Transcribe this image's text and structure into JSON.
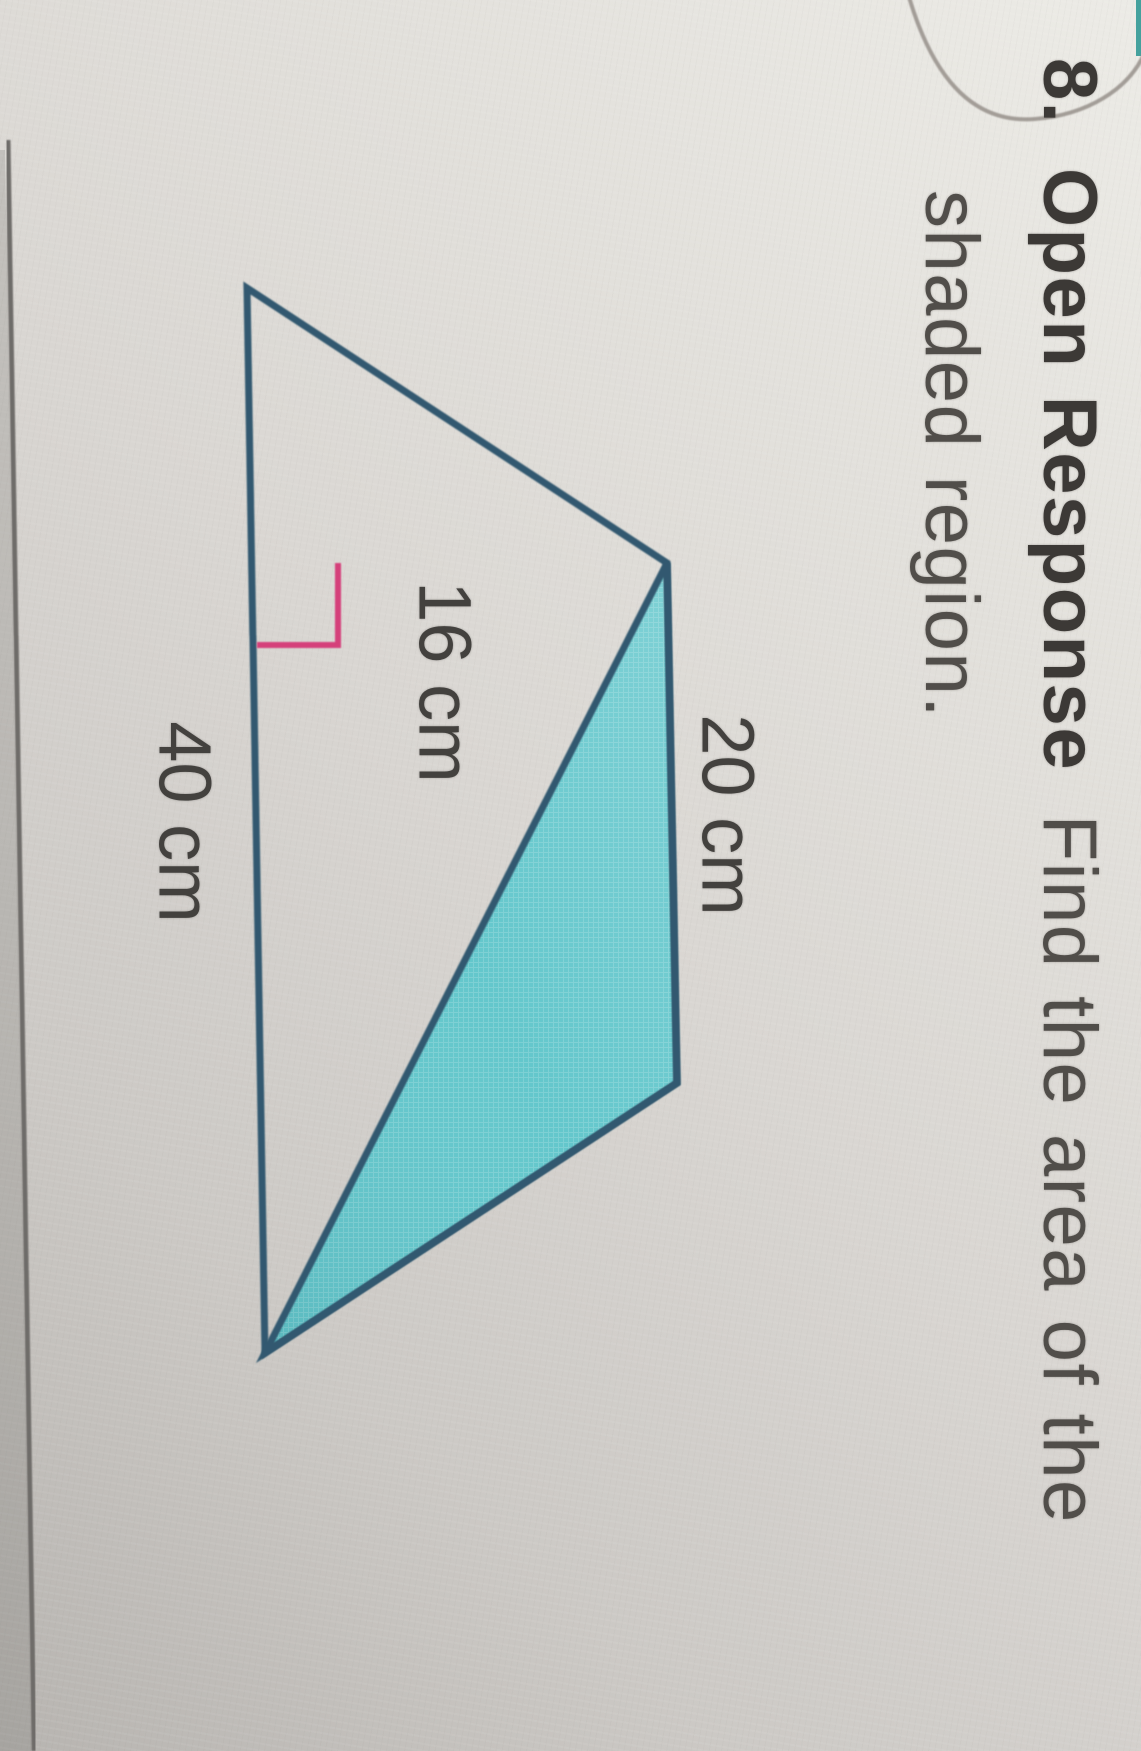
{
  "page": {
    "problem_number": "8.",
    "problem_type": "Open Response",
    "prompt_rest": "Find the area of the",
    "prompt_line2": "shaded region."
  },
  "figure": {
    "shape": "quadrilateral-with-shaded-triangle",
    "label_top_side": "20 cm",
    "label_height": "16 cm",
    "label_base": "40 cm"
  },
  "colors": {
    "outline_blue": "#30596f",
    "shaded_teal": "#64c7cc",
    "height_pink": "#d5417a",
    "paper": "#dcd9d5",
    "text_dark": "#3c3936"
  }
}
